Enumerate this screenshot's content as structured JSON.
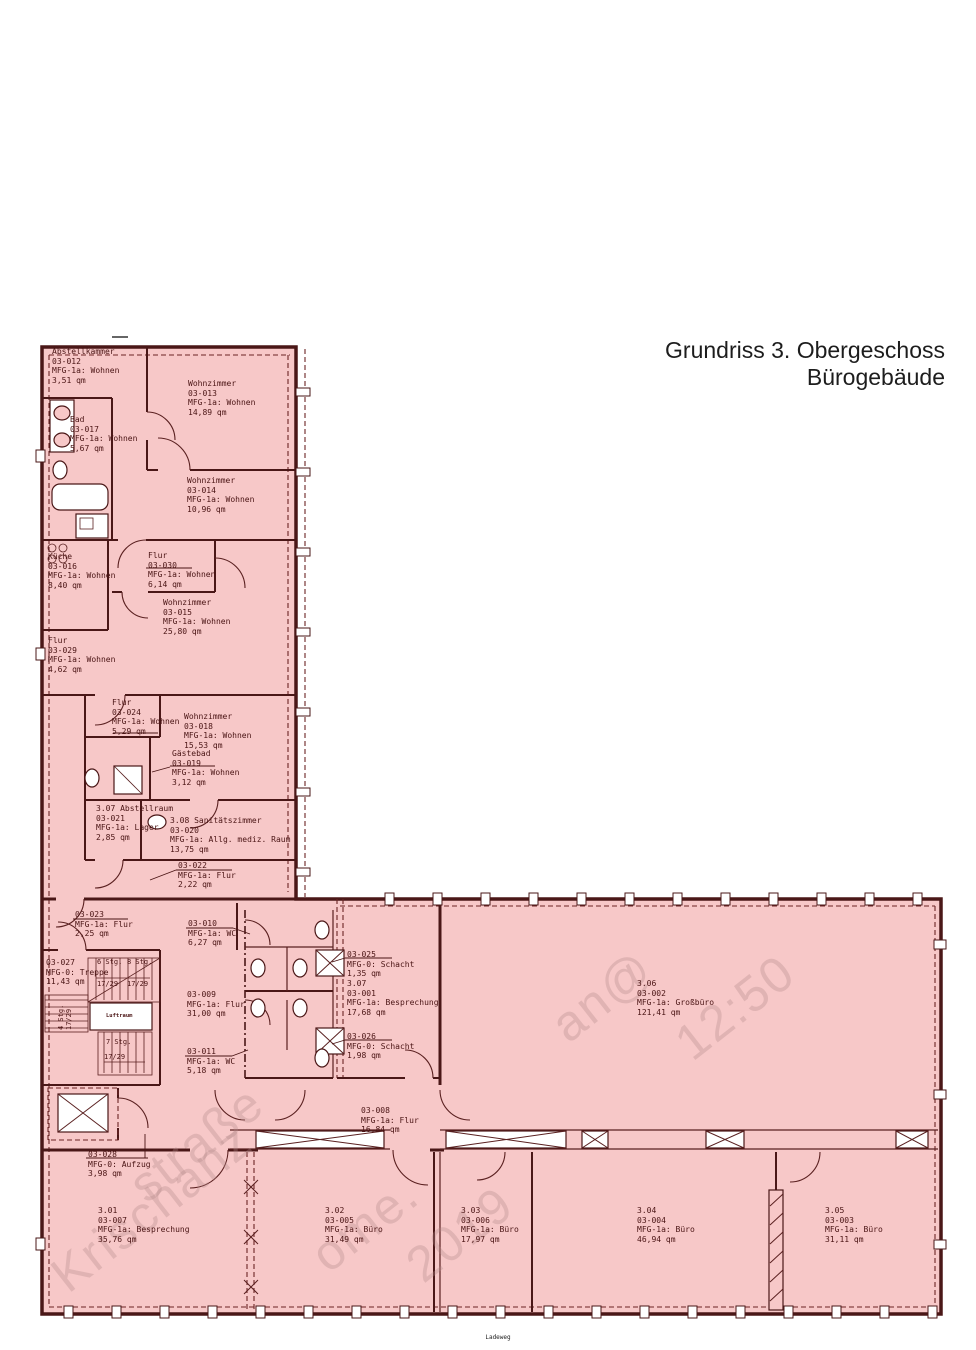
{
  "title": {
    "line1": "Grundriss 3. Obergeschoss",
    "line2": "Bürogebäude"
  },
  "footer_text": "Ladeweg",
  "rooms": [
    {
      "id": "03-012",
      "lines": [
        "Abstellkammer",
        "03-012",
        "MFG-1a: Wohnen",
        "3,51 qm"
      ],
      "x": 52,
      "y": 347
    },
    {
      "id": "03-013",
      "lines": [
        "Wohnzimmer",
        "03-013",
        "MFG-1a: Wohnen",
        "14,89 qm"
      ],
      "x": 188,
      "y": 379
    },
    {
      "id": "03-017",
      "lines": [
        "Bad",
        "03-017",
        "MFG-1a: Wohnen",
        "5,67 qm"
      ],
      "x": 70,
      "y": 415
    },
    {
      "id": "03-014",
      "lines": [
        "Wohnzimmer",
        "03-014",
        "MFG-1a: Wohnen",
        "10,96 qm"
      ],
      "x": 187,
      "y": 476
    },
    {
      "id": "03-016",
      "lines": [
        "Küche",
        "03-016",
        "MFG-1a: Wohnen",
        "8,40 qm"
      ],
      "x": 48,
      "y": 552
    },
    {
      "id": "03-030",
      "lines": [
        "Flur",
        "03-030",
        "MFG-1a: Wohnen",
        "6,14 qm"
      ],
      "x": 148,
      "y": 551
    },
    {
      "id": "03-015",
      "lines": [
        "Wohnzimmer",
        "03-015",
        "MFG-1a: Wohnen",
        "25,80 qm"
      ],
      "x": 163,
      "y": 598
    },
    {
      "id": "03-029",
      "lines": [
        "Flur",
        "03-029",
        "MFG-1a: Wohnen",
        "4,62 qm"
      ],
      "x": 48,
      "y": 636
    },
    {
      "id": "03-024",
      "lines": [
        "Flur",
        "03-024",
        "MFG-1a: Wohnen",
        "5,29 qm"
      ],
      "x": 112,
      "y": 698
    },
    {
      "id": "03-018",
      "lines": [
        "Wohnzimmer",
        "03-018",
        "MFG-1a: Wohnen",
        "15,53 qm"
      ],
      "x": 184,
      "y": 712
    },
    {
      "id": "03-019",
      "lines": [
        "Gästebad",
        "03-019",
        "MFG-1a: Wohnen",
        "3,12 qm"
      ],
      "x": 172,
      "y": 749
    },
    {
      "id": "03-021",
      "lines": [
        "3.07 Abstellraum",
        "03-021",
        "MFG-1a: Lager",
        "2,85 qm"
      ],
      "x": 96,
      "y": 804
    },
    {
      "id": "03-020",
      "lines": [
        "3.08 Sanitätszimmer",
        "03-020",
        "MFG-1a: Allg. mediz. Raum",
        "13,75 qm"
      ],
      "x": 170,
      "y": 816
    },
    {
      "id": "03-022",
      "lines": [
        "03-022",
        "MFG-1a: Flur",
        "2,22 qm"
      ],
      "x": 178,
      "y": 861
    },
    {
      "id": "03-023",
      "lines": [
        "03-023",
        "MFG-1a: Flur",
        "2,25 qm"
      ],
      "x": 75,
      "y": 910
    },
    {
      "id": "03-010",
      "lines": [
        "03-010",
        "MFG-1a: WC",
        "6,27 qm"
      ],
      "x": 188,
      "y": 919
    },
    {
      "id": "03-027",
      "lines": [
        "03-027",
        "MFG-0: Treppe",
        "11,43 qm"
      ],
      "x": 46,
      "y": 958
    },
    {
      "id": "03-009",
      "lines": [
        "03-009",
        "MFG-1a: Flur",
        "31,00 qm"
      ],
      "x": 187,
      "y": 990
    },
    {
      "id": "03-011",
      "lines": [
        "03-011",
        "MFG-1a: WC",
        "5,18 qm"
      ],
      "x": 187,
      "y": 1047
    },
    {
      "id": "03-025",
      "lines": [
        "03-025",
        "MFG-0: Schacht",
        "1,35 qm"
      ],
      "x": 347,
      "y": 950
    },
    {
      "id": "03-001",
      "lines": [
        "3.07",
        "03-001",
        "MFG-1a: Besprechung",
        "17,68 qm"
      ],
      "x": 347,
      "y": 979
    },
    {
      "id": "03-026",
      "lines": [
        "03-026",
        "MFG-0: Schacht",
        "1,98 qm"
      ],
      "x": 347,
      "y": 1032
    },
    {
      "id": "03-028",
      "lines": [
        "03-028",
        "MFG-0: Aufzug",
        "3,98 qm"
      ],
      "x": 88,
      "y": 1150
    },
    {
      "id": "03-008",
      "lines": [
        "03-008",
        "MFG-1a: Flur",
        "16,84 qm"
      ],
      "x": 361,
      "y": 1106
    },
    {
      "id": "03-002",
      "lines": [
        "3.06",
        "03-002",
        "MFG-1a: Großbüro",
        "121,41 qm"
      ],
      "x": 637,
      "y": 979
    },
    {
      "id": "03-007",
      "lines": [
        "3.01",
        "03-007",
        "MFG-1a: Besprechung",
        "35,76 qm"
      ],
      "x": 98,
      "y": 1206
    },
    {
      "id": "03-005",
      "lines": [
        "3.02",
        "03-005",
        "MFG-1a: Büro",
        "31,49 qm"
      ],
      "x": 325,
      "y": 1206
    },
    {
      "id": "03-006",
      "lines": [
        "3.03",
        "03-006",
        "MFG-1a: Büro",
        "17,97 qm"
      ],
      "x": 461,
      "y": 1206
    },
    {
      "id": "03-004",
      "lines": [
        "3.04",
        "03-004",
        "MFG-1a: Büro",
        "46,94 qm"
      ],
      "x": 637,
      "y": 1206
    },
    {
      "id": "03-003",
      "lines": [
        "3.05",
        "03-003",
        "MFG-1a: Büro",
        "31,11 qm"
      ],
      "x": 825,
      "y": 1206
    }
  ],
  "stair_annotations": [
    {
      "text": "6 Stg.",
      "x": 97,
      "y": 958
    },
    {
      "text": "17/29",
      "x": 97,
      "y": 980
    },
    {
      "text": "8 Stg.",
      "x": 127,
      "y": 958
    },
    {
      "text": "17/29",
      "x": 127,
      "y": 980
    },
    {
      "text": "4 Stg.\n17/29",
      "x": 57,
      "y": 1030,
      "rot": true
    },
    {
      "text": "Luftraum",
      "x": 106,
      "y": 1013,
      "small": true
    },
    {
      "text": "7 Stg.",
      "x": 106,
      "y": 1038
    },
    {
      "text": "17/29",
      "x": 104,
      "y": 1053
    }
  ],
  "watermark_fragments": [
    {
      "text": "Krischanz",
      "x": 40,
      "y": 1258,
      "size": 50
    },
    {
      "text": "straße",
      "x": 118,
      "y": 1168,
      "size": 50
    },
    {
      "text": "ome.",
      "x": 300,
      "y": 1238,
      "size": 50
    },
    {
      "text": "2019",
      "x": 395,
      "y": 1248,
      "size": 50
    },
    {
      "text": "an@",
      "x": 540,
      "y": 1008,
      "size": 50
    },
    {
      "text": "12:50",
      "x": 664,
      "y": 1026,
      "size": 50
    }
  ]
}
